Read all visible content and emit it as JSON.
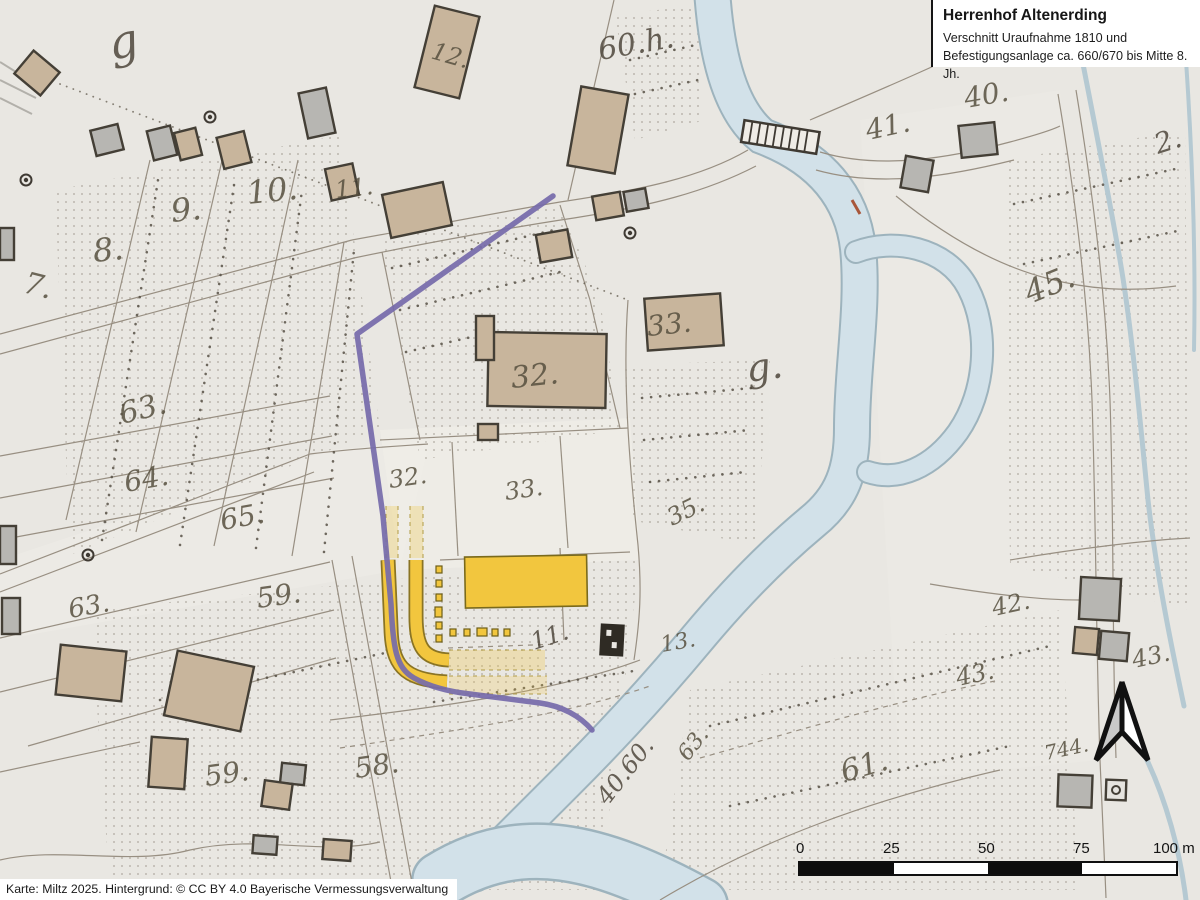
{
  "title_box": {
    "title": "Herrenhof Altenerding",
    "subtitle_line1": "Verschnitt Uraufnahme 1810 und",
    "subtitle_line2": "Befestigungsanlage ca. 660/670 bis Mitte 8. Jh."
  },
  "attribution": "Karte: Miltz 2025. Hintergrund: © CC BY 4.0 Bayerische Vermessungsverwaltung",
  "scale_bar": {
    "labels": [
      "0",
      "25",
      "50",
      "75",
      "100 m"
    ]
  },
  "colors": {
    "fortification_purple": "#756aaa",
    "herrenhof_yellow": "#f2c63e",
    "river_blue": "#d2e1e9",
    "building_tan": "#c8b59c",
    "paper": "#e9e7e2"
  },
  "map": {
    "parcel_labels": [
      {
        "text": "g",
        "x": 112,
        "y": 60,
        "size": 46,
        "rot": -12,
        "script": true
      },
      {
        "text": "7.",
        "x": 22,
        "y": 292,
        "size": 30,
        "rot": 14
      },
      {
        "text": "8.",
        "x": 94,
        "y": 262,
        "size": 32,
        "rot": -6
      },
      {
        "text": "9.",
        "x": 172,
        "y": 222,
        "size": 32,
        "rot": -6
      },
      {
        "text": "10.",
        "x": 248,
        "y": 204,
        "size": 32,
        "rot": -6
      },
      {
        "text": "11.",
        "x": 336,
        "y": 198,
        "size": 24,
        "rot": -6
      },
      {
        "text": "12.",
        "x": 430,
        "y": 58,
        "size": 24,
        "rot": 16
      },
      {
        "text": "60.h.",
        "x": 600,
        "y": 60,
        "size": 30,
        "rot": -10,
        "script": true
      },
      {
        "text": "41.",
        "x": 868,
        "y": 140,
        "size": 28,
        "rot": -12
      },
      {
        "text": "40.",
        "x": 966,
        "y": 108,
        "size": 28,
        "rot": -10
      },
      {
        "text": "45.",
        "x": 1030,
        "y": 304,
        "size": 32,
        "rot": -22
      },
      {
        "text": "33.",
        "x": 648,
        "y": 336,
        "size": 28,
        "rot": -6
      },
      {
        "text": "32.",
        "x": 512,
        "y": 388,
        "size": 30,
        "rot": -6
      },
      {
        "text": "g.",
        "x": 748,
        "y": 382,
        "size": 38,
        "rot": -8,
        "script": true
      },
      {
        "text": "63.",
        "x": 122,
        "y": 424,
        "size": 30,
        "rot": -14
      },
      {
        "text": "64.",
        "x": 126,
        "y": 492,
        "size": 28,
        "rot": -10
      },
      {
        "text": "65.",
        "x": 222,
        "y": 530,
        "size": 28,
        "rot": -10
      },
      {
        "text": "63.",
        "x": 70,
        "y": 618,
        "size": 26,
        "rot": -10
      },
      {
        "text": "32.",
        "x": 390,
        "y": 488,
        "size": 24,
        "rot": -8
      },
      {
        "text": "33.",
        "x": 506,
        "y": 500,
        "size": 24,
        "rot": -8
      },
      {
        "text": "35.",
        "x": 672,
        "y": 526,
        "size": 24,
        "rot": -26
      },
      {
        "text": "59.",
        "x": 258,
        "y": 608,
        "size": 28,
        "rot": -8
      },
      {
        "text": "42.",
        "x": 994,
        "y": 616,
        "size": 24,
        "rot": -12
      },
      {
        "text": "43.",
        "x": 958,
        "y": 686,
        "size": 24,
        "rot": -12
      },
      {
        "text": "43.",
        "x": 1134,
        "y": 668,
        "size": 24,
        "rot": -12
      },
      {
        "text": "11.",
        "x": 534,
        "y": 650,
        "size": 24,
        "rot": -18,
        "script": true
      },
      {
        "text": "13.",
        "x": 662,
        "y": 652,
        "size": 22,
        "rot": -10
      },
      {
        "text": "59.",
        "x": 206,
        "y": 786,
        "size": 28,
        "rot": -8
      },
      {
        "text": "58.",
        "x": 356,
        "y": 778,
        "size": 28,
        "rot": -8
      },
      {
        "text": "61.",
        "x": 844,
        "y": 782,
        "size": 30,
        "rot": -16
      },
      {
        "text": "40.60.",
        "x": 608,
        "y": 806,
        "size": 24,
        "rot": -52,
        "script": true
      },
      {
        "text": "63.",
        "x": 688,
        "y": 762,
        "size": 22,
        "rot": -52
      },
      {
        "text": "744.",
        "x": 1046,
        "y": 760,
        "size": 20,
        "rot": -12
      },
      {
        "text": "2.",
        "x": 1158,
        "y": 154,
        "size": 28,
        "rot": -18,
        "script": true
      }
    ]
  }
}
